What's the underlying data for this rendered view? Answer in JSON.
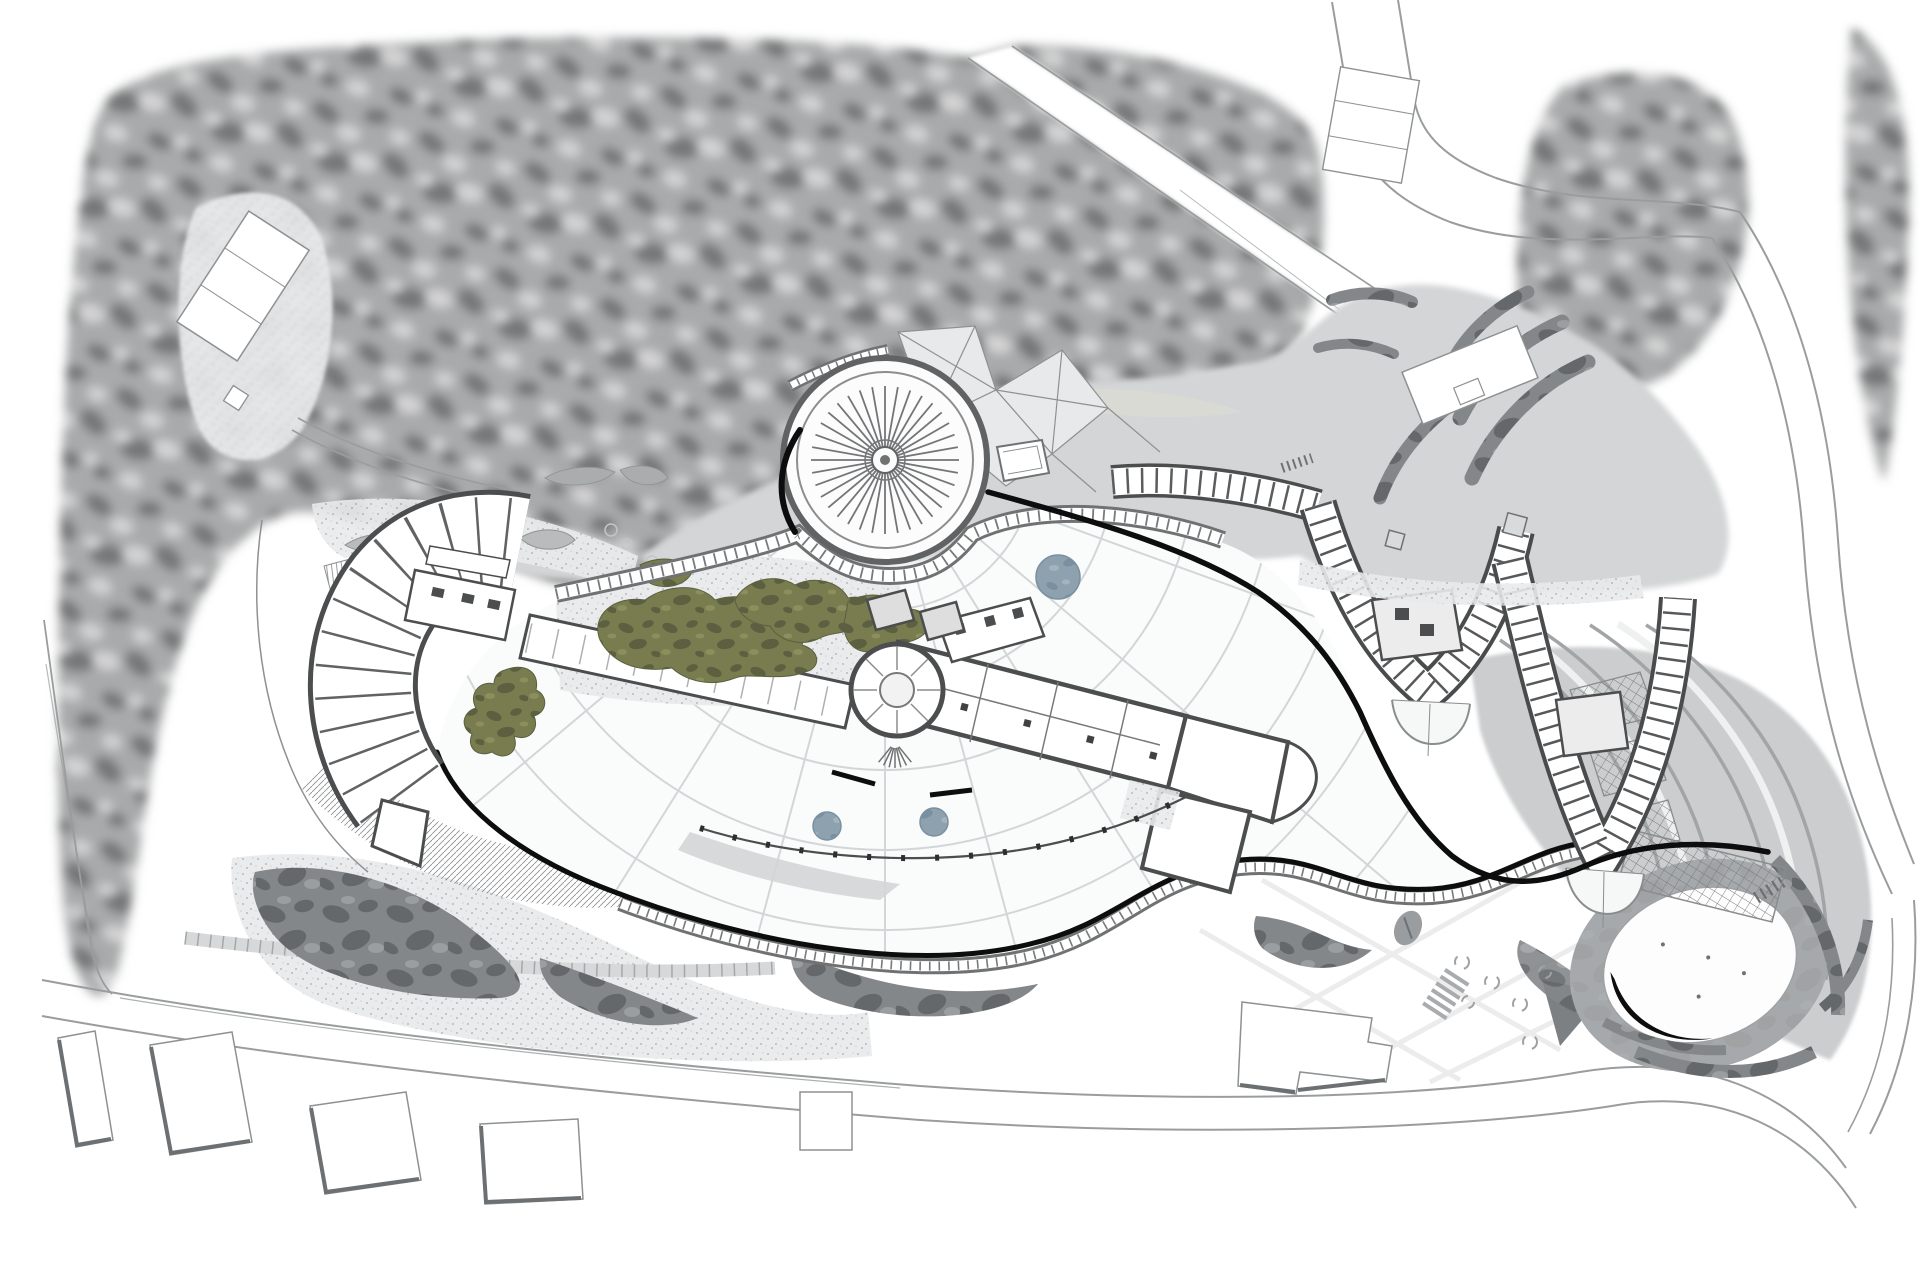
{
  "document": {
    "kind": "architectural master site plan (top-down drawing)",
    "visible_text": [],
    "style": "grayscale line drawing with selective color accents"
  },
  "palette": {
    "paper": "#ffffff",
    "forest_base": "#a9aaab",
    "forest_dark": "#767778",
    "forest_light": "#d3d3d4",
    "meadow": "#d3d5d6",
    "sand": "#dadbd3",
    "road_line": "#9a9d9e",
    "stipple_bg": "#e9eaeb",
    "stipple_dot": "#b3b5b6",
    "camo": "#84878a",
    "camo_dark": "#65686a",
    "camo_light": "#9b9ea0",
    "green": "#787c4f",
    "green_dark": "#5c6040",
    "green_light": "#8b8f5e",
    "fountain": "#8da1ae",
    "fountain_dark": "#7a90a0",
    "fountain_light": "#a4b4be",
    "wall": "#4b4d4e",
    "line_gray": "#77797b",
    "grid_line": "#d3d6d8",
    "grid_faint": "#ececec",
    "ink": "#0d0d0d",
    "terrace": "#c2c5c6",
    "terrace_line": "#a2a5a6",
    "terrace_light": "#eff0f0",
    "pond_ring": "#b0b3b4",
    "trellis_line": "#777a7c",
    "hatch_line": "#8f9294",
    "bean": "#b9bcbd",
    "shadow_edge": "#6d7072",
    "paving": "#d6d8d9",
    "paving_tick": "#a5a8a9",
    "shrub": "#9a9da0",
    "facet": "#e8e9ea"
  },
  "features": {
    "landscape": [
      {
        "id": "forest-canopy",
        "label": "dense tree canopy masses",
        "color": "forest_base"
      },
      {
        "id": "tree-clearing",
        "label": "clearing with court in forest",
        "color": "stipple_bg"
      },
      {
        "id": "meadow-lawn",
        "label": "soft gray lawn / water meadow behind dome",
        "color": "meadow"
      },
      {
        "id": "planting-green",
        "label": "olive organic planting beds",
        "color": "green"
      },
      {
        "id": "gravel-garden",
        "label": "stippled gravel gardens",
        "color": "stipple_bg"
      },
      {
        "id": "shrub-mass",
        "label": "dark mottled shrub masses",
        "color": "camo"
      },
      {
        "id": "hedge-crescents",
        "label": "crescent hedge beds at drop-off",
        "color": "camo"
      },
      {
        "id": "terraced-slope",
        "label": "flowing terraced slope with contour bands",
        "color": "terrace"
      },
      {
        "id": "trellis-panels",
        "label": "cross-hatched trellis panels",
        "color": "trellis_line"
      },
      {
        "id": "pergola",
        "label": "pergola lattice beside pond",
        "color": "trellis_line"
      }
    ],
    "water": [
      {
        "id": "fountain-pools",
        "label": "three circular blue-gray pools",
        "color": "fountain"
      },
      {
        "id": "oval-pond",
        "label": "elliptical pond with dark rim",
        "color": "pond_ring"
      }
    ],
    "circulation": [
      {
        "id": "roads",
        "label": "perimeter roads",
        "color": "road_line"
      },
      {
        "id": "diagonal-road",
        "label": "diagonal road through forest",
        "color": "road_line"
      },
      {
        "id": "paving-grid",
        "label": "warped paving grid of plaza",
        "color": "grid_line"
      },
      {
        "id": "promenade-walkway",
        "label": "serpentine promenade with railing rungs",
        "color": "line_gray"
      },
      {
        "id": "glazed-gallery",
        "label": "curved glazed gallery walkway",
        "color": "line_gray"
      },
      {
        "id": "crosswalk",
        "label": "zebra crosswalk",
        "color": "road_line"
      },
      {
        "id": "stair-steps",
        "label": "outdoor steps",
        "color": "shadow_edge"
      }
    ],
    "buildings": [
      {
        "id": "radial-roof-dome",
        "label": "circular radial-spoke roof",
        "color": "wall"
      },
      {
        "id": "faceted-canopy",
        "label": "triangulated glass canopy",
        "color": "facet"
      },
      {
        "id": "fan-wing",
        "label": "fan-shaped west guestroom wing",
        "color": "wall"
      },
      {
        "id": "central-lobby",
        "label": "central lobby slab with rotunda",
        "color": "wall"
      },
      {
        "id": "guestroom-wing-v1",
        "label": "first V-shaped guestroom wing",
        "color": "wall"
      },
      {
        "id": "guestroom-wing-v2",
        "label": "second V-shaped guestroom wing",
        "color": "wall"
      },
      {
        "id": "podium-edge",
        "label": "bold black podium edge walls",
        "color": "ink"
      },
      {
        "id": "parking-pavilion",
        "label": "rectangular pavilion at drop-off",
        "color": "paper"
      },
      {
        "id": "building-footprints",
        "label": "six neighbouring building footprints along road",
        "color": "shadow_edge"
      },
      {
        "id": "tennis-court",
        "label": "court rectangles",
        "color": "paper"
      }
    ]
  }
}
